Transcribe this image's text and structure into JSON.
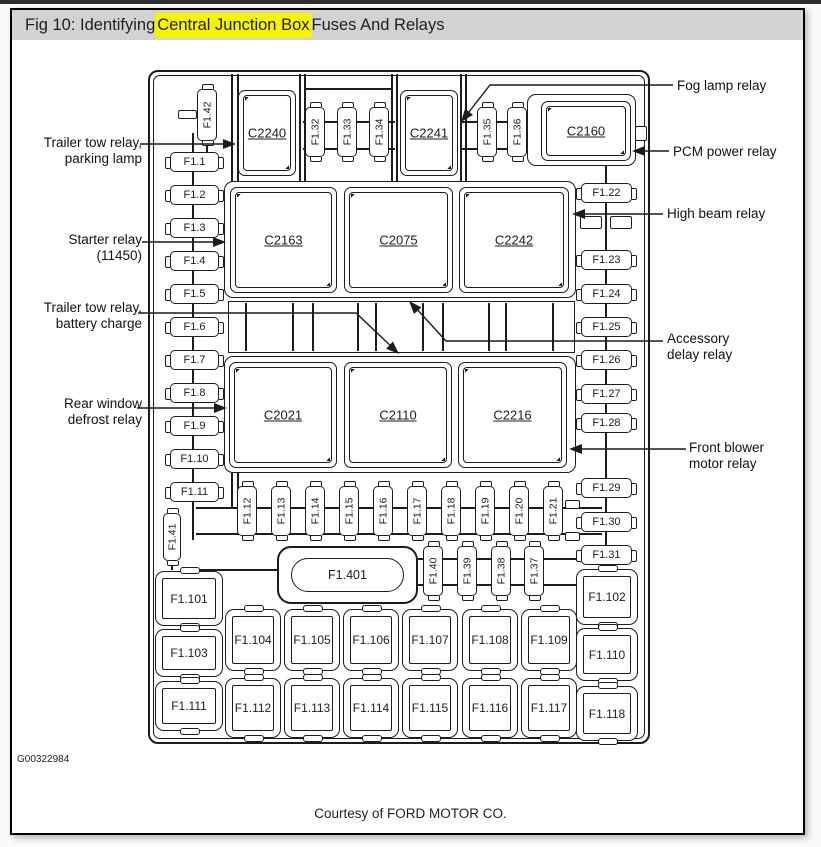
{
  "title": {
    "prefix": "Fig 10: Identifying ",
    "highlight": "Central Junction Box",
    "suffix": " Fuses And Relays",
    "highlight_color": "#f7f400",
    "bar_color": "#d2d2d2"
  },
  "footer": {
    "code": "G00322984",
    "courtesy": "Courtesy of FORD MOTOR CO."
  },
  "callouts": {
    "left": [
      {
        "line1": "Trailer tow relay,",
        "line2": "parking lamp",
        "leader": {
          "points": [
            [
              140,
              144
            ],
            [
              227,
              144
            ]
          ],
          "tip": [
            236,
            144
          ],
          "angle": 0
        }
      },
      {
        "line1": "Starter relay",
        "line2": "(11450)",
        "leader": {
          "points": [
            [
              142,
              242
            ],
            [
              217,
              242
            ]
          ],
          "tip": [
            226,
            242
          ],
          "angle": 0
        }
      },
      {
        "line1": "Trailer tow relay,",
        "line2": "battery charge",
        "leader": {
          "points": [
            [
              138,
              313
            ],
            [
              356,
              313
            ],
            [
              394,
              349
            ]
          ],
          "tip": [
            399,
            354
          ],
          "angle": 43
        }
      },
      {
        "line1": "Rear window",
        "line2": "defrost relay",
        "leader": {
          "points": [
            [
              137,
              408
            ],
            [
              218,
              408
            ]
          ],
          "tip": [
            227,
            408
          ],
          "angle": 0
        }
      }
    ],
    "right": [
      {
        "line1": "Fog lamp relay",
        "line2": "",
        "leader": {
          "points": [
            [
              673,
              85
            ],
            [
              490,
              85
            ],
            [
              465,
              117
            ]
          ],
          "tip": [
            461,
            122
          ],
          "angle": 128
        }
      },
      {
        "line1": "PCM power relay",
        "line2": "",
        "leader": {
          "points": [
            [
              669,
              151
            ],
            [
              641,
              151
            ]
          ],
          "tip": [
            632,
            151
          ],
          "angle": 180
        }
      },
      {
        "line1": "High beam relay",
        "line2": "",
        "leader": {
          "points": [
            [
              663,
              214
            ],
            [
              581,
              214
            ]
          ],
          "tip": [
            572,
            214
          ],
          "angle": 180
        }
      },
      {
        "line1": "Accessory",
        "line2": "delay relay",
        "leader": {
          "points": [
            [
              663,
              341
            ],
            [
              446,
              341
            ],
            [
              414,
              306
            ]
          ],
          "tip": [
            409,
            301
          ],
          "angle": 228
        }
      },
      {
        "line1": "Front blower",
        "line2": "motor relay",
        "leader": {
          "points": [
            [
              686,
              449
            ],
            [
              578,
              449
            ]
          ],
          "tip": [
            569,
            449
          ],
          "angle": 180
        }
      }
    ]
  },
  "diagram": {
    "line_color": "#1c1c1c",
    "outer": {
      "x": 148,
      "y": 70,
      "w": 502,
      "h": 674
    },
    "pockets": [
      {
        "x": 224,
        "y": 181,
        "w": 352,
        "h": 117
      },
      {
        "x": 224,
        "y": 356,
        "w": 352,
        "h": 117
      },
      {
        "x": 527,
        "y": 94,
        "w": 109,
        "h": 72
      }
    ],
    "connectors": [
      {
        "label": "C2240",
        "x": 238,
        "y": 90,
        "w": 58,
        "h": 86
      },
      {
        "label": "C2241",
        "x": 400,
        "y": 90,
        "w": 58,
        "h": 86
      },
      {
        "label": "C2160",
        "x": 541,
        "y": 101,
        "w": 90,
        "h": 60
      },
      {
        "label": "C2163",
        "x": 230,
        "y": 187,
        "w": 107,
        "h": 106
      },
      {
        "label": "C2075",
        "x": 344,
        "y": 187,
        "w": 109,
        "h": 106
      },
      {
        "label": "C2242",
        "x": 459,
        "y": 187,
        "w": 110,
        "h": 106
      },
      {
        "label": "C2021",
        "x": 229,
        "y": 362,
        "w": 108,
        "h": 106
      },
      {
        "label": "C2110",
        "x": 344,
        "y": 362,
        "w": 108,
        "h": 106
      },
      {
        "label": "C2216",
        "x": 458,
        "y": 362,
        "w": 109,
        "h": 106
      }
    ],
    "hfuses": [
      {
        "label": "F1.1",
        "x": 170,
        "y": 152
      },
      {
        "label": "F1.2",
        "x": 170,
        "y": 185
      },
      {
        "label": "F1.3",
        "x": 170,
        "y": 218
      },
      {
        "label": "F1.4",
        "x": 170,
        "y": 251
      },
      {
        "label": "F1.5",
        "x": 170,
        "y": 284
      },
      {
        "label": "F1.6",
        "x": 170,
        "y": 317
      },
      {
        "label": "F1.7",
        "x": 170,
        "y": 350
      },
      {
        "label": "F1.8",
        "x": 170,
        "y": 383
      },
      {
        "label": "F1.9",
        "x": 170,
        "y": 416
      },
      {
        "label": "F1.10",
        "x": 170,
        "y": 449
      },
      {
        "label": "F1.11",
        "x": 170,
        "y": 482
      },
      {
        "label": "F1.22",
        "x": 581,
        "y": 183,
        "w": 51
      },
      {
        "label": "F1.23",
        "x": 581,
        "y": 250,
        "w": 51
      },
      {
        "label": "F1.24",
        "x": 581,
        "y": 284,
        "w": 51
      },
      {
        "label": "F1.25",
        "x": 581,
        "y": 317,
        "w": 51
      },
      {
        "label": "F1.26",
        "x": 581,
        "y": 350,
        "w": 51
      },
      {
        "label": "F1.27",
        "x": 581,
        "y": 384,
        "w": 51
      },
      {
        "label": "F1.28",
        "x": 581,
        "y": 413,
        "w": 51
      },
      {
        "label": "F1.29",
        "x": 581,
        "y": 478,
        "w": 51
      },
      {
        "label": "F1.30",
        "x": 581,
        "y": 512,
        "w": 51
      },
      {
        "label": "F1.31",
        "x": 581,
        "y": 545,
        "w": 51
      }
    ],
    "vfuses": [
      {
        "label": "F1.42",
        "x": 197,
        "y": 89,
        "h": 52
      },
      {
        "label": "F1.32",
        "x": 305,
        "y": 107
      },
      {
        "label": "F1.33",
        "x": 337,
        "y": 107
      },
      {
        "label": "F1.34",
        "x": 369,
        "y": 107
      },
      {
        "label": "F1.35",
        "x": 477,
        "y": 107
      },
      {
        "label": "F1.36",
        "x": 507,
        "y": 107
      },
      {
        "label": "F1.12",
        "x": 237,
        "y": 486
      },
      {
        "label": "F1.13",
        "x": 271,
        "y": 486
      },
      {
        "label": "F1.14",
        "x": 305,
        "y": 486
      },
      {
        "label": "F1.15",
        "x": 339,
        "y": 486
      },
      {
        "label": "F1.16",
        "x": 373,
        "y": 486
      },
      {
        "label": "F1.17",
        "x": 407,
        "y": 486
      },
      {
        "label": "F1.18",
        "x": 441,
        "y": 486
      },
      {
        "label": "F1.19",
        "x": 475,
        "y": 486
      },
      {
        "label": "F1.20",
        "x": 509,
        "y": 486
      },
      {
        "label": "F1.21",
        "x": 543,
        "y": 486
      },
      {
        "label": "F1.40",
        "x": 423,
        "y": 546
      },
      {
        "label": "F1.39",
        "x": 457,
        "y": 546
      },
      {
        "label": "F1.38",
        "x": 491,
        "y": 546
      },
      {
        "label": "F1.37",
        "x": 524,
        "y": 546
      },
      {
        "label": "F1.41",
        "x": 163,
        "y": 513,
        "w": 18,
        "h": 48
      }
    ],
    "relays": [
      {
        "label": "F1.101",
        "x": 155,
        "y": 571,
        "w": 68,
        "h": 55
      },
      {
        "label": "F1.103",
        "x": 155,
        "y": 629,
        "w": 68,
        "h": 48
      },
      {
        "label": "F1.111",
        "x": 155,
        "y": 681,
        "w": 68,
        "h": 50
      },
      {
        "label": "F1.104",
        "x": 225,
        "y": 609,
        "w": 56,
        "h": 62
      },
      {
        "label": "F1.105",
        "x": 284,
        "y": 609,
        "w": 56,
        "h": 62
      },
      {
        "label": "F1.106",
        "x": 343,
        "y": 609,
        "w": 56,
        "h": 62
      },
      {
        "label": "F1.107",
        "x": 402,
        "y": 609,
        "w": 56,
        "h": 62
      },
      {
        "label": "F1.108",
        "x": 462,
        "y": 609,
        "w": 56,
        "h": 62
      },
      {
        "label": "F1.109",
        "x": 521,
        "y": 609,
        "w": 56,
        "h": 62
      },
      {
        "label": "F1.112",
        "x": 225,
        "y": 678,
        "w": 56,
        "h": 60
      },
      {
        "label": "F1.113",
        "x": 284,
        "y": 678,
        "w": 56,
        "h": 60
      },
      {
        "label": "F1.114",
        "x": 343,
        "y": 678,
        "w": 56,
        "h": 60
      },
      {
        "label": "F1.115",
        "x": 402,
        "y": 678,
        "w": 56,
        "h": 60
      },
      {
        "label": "F1.116",
        "x": 462,
        "y": 678,
        "w": 56,
        "h": 60
      },
      {
        "label": "F1.117",
        "x": 521,
        "y": 678,
        "w": 56,
        "h": 60
      },
      {
        "label": "F1.102",
        "x": 576,
        "y": 569,
        "w": 62,
        "h": 56
      },
      {
        "label": "F1.110",
        "x": 576,
        "y": 628,
        "w": 62,
        "h": 53
      },
      {
        "label": "F1.118",
        "x": 576,
        "y": 686,
        "w": 62,
        "h": 55
      }
    ],
    "pill": {
      "label": "F1.401",
      "x": 277,
      "y": 546,
      "w": 141,
      "h": 58
    },
    "band": {
      "x": 228,
      "y": 301,
      "w": 347,
      "h": 52,
      "dividers": [
        245,
        292,
        312,
        357,
        375,
        422,
        442,
        488,
        505,
        552
      ]
    },
    "hlines": [
      {
        "x": 305,
        "y": 88,
        "len": 86
      },
      {
        "x": 303,
        "y": 121,
        "len": 92
      },
      {
        "x": 303,
        "y": 148,
        "len": 92
      },
      {
        "x": 462,
        "y": 121,
        "len": 66
      },
      {
        "x": 462,
        "y": 148,
        "len": 66
      },
      {
        "x": 196,
        "y": 507,
        "len": 406
      },
      {
        "x": 196,
        "y": 533,
        "len": 406
      },
      {
        "x": 418,
        "y": 558,
        "len": 184
      },
      {
        "x": 418,
        "y": 584,
        "len": 184
      },
      {
        "x": 181,
        "y": 569,
        "len": 96
      }
    ],
    "vlines": [
      {
        "x": 192,
        "y": 133,
        "len": 407
      },
      {
        "x": 605,
        "y": 165,
        "len": 400
      },
      {
        "x": 231,
        "y": 74,
        "len": 108
      },
      {
        "x": 237,
        "y": 74,
        "len": 108
      },
      {
        "x": 231,
        "y": 473,
        "len": 36
      },
      {
        "x": 237,
        "y": 473,
        "len": 36
      },
      {
        "x": 299,
        "y": 74,
        "len": 107
      },
      {
        "x": 304,
        "y": 74,
        "len": 107
      },
      {
        "x": 391,
        "y": 74,
        "len": 107
      },
      {
        "x": 396,
        "y": 74,
        "len": 107
      },
      {
        "x": 460,
        "y": 74,
        "len": 107
      },
      {
        "x": 465,
        "y": 74,
        "len": 107
      },
      {
        "x": 206,
        "y": 139,
        "len": 14
      },
      {
        "x": 171,
        "y": 559,
        "len": 11
      }
    ],
    "tabs": [
      {
        "x": 178,
        "y": 110,
        "w": 19,
        "h": 9
      },
      {
        "x": 635,
        "y": 126,
        "w": 12,
        "h": 15
      },
      {
        "x": 580,
        "y": 216,
        "w": 22,
        "h": 13
      },
      {
        "x": 610,
        "y": 216,
        "w": 22,
        "h": 13
      },
      {
        "x": 565,
        "y": 500,
        "w": 15,
        "h": 9
      },
      {
        "x": 565,
        "y": 532,
        "w": 15,
        "h": 9
      }
    ]
  }
}
